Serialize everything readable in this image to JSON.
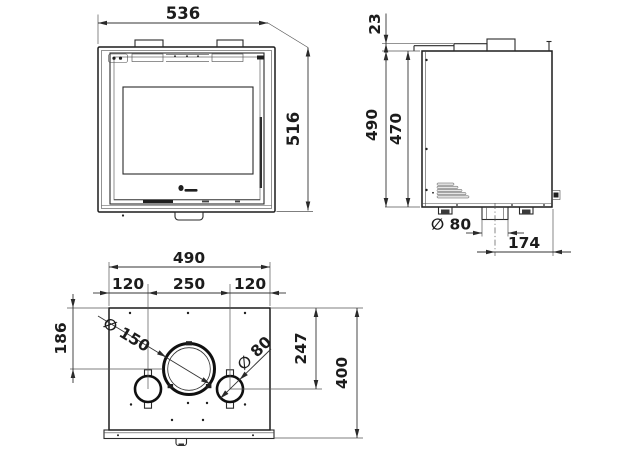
{
  "drawing": {
    "type": "technical-dimension-drawing",
    "colors": {
      "ink": "#1b1b1b",
      "paper": "#ffffff"
    },
    "views": {
      "front": {
        "dim_width": "536",
        "dim_height": "516"
      },
      "side": {
        "dim_collar_height": "23",
        "dim_overall_height": "490",
        "dim_body_height": "470",
        "dim_outlet_diameter": "∅ 80",
        "dim_outlet_offset": "174"
      },
      "top": {
        "dim_width": "490",
        "dim_seg_left": "120",
        "dim_seg_center": "250",
        "dim_seg_right": "120",
        "dim_flue_depth": "186",
        "dim_air_depth": "247",
        "dim_depth": "400",
        "dim_flue_diameter": "∅ 150",
        "dim_air_diameter": "∅ 80"
      }
    }
  }
}
